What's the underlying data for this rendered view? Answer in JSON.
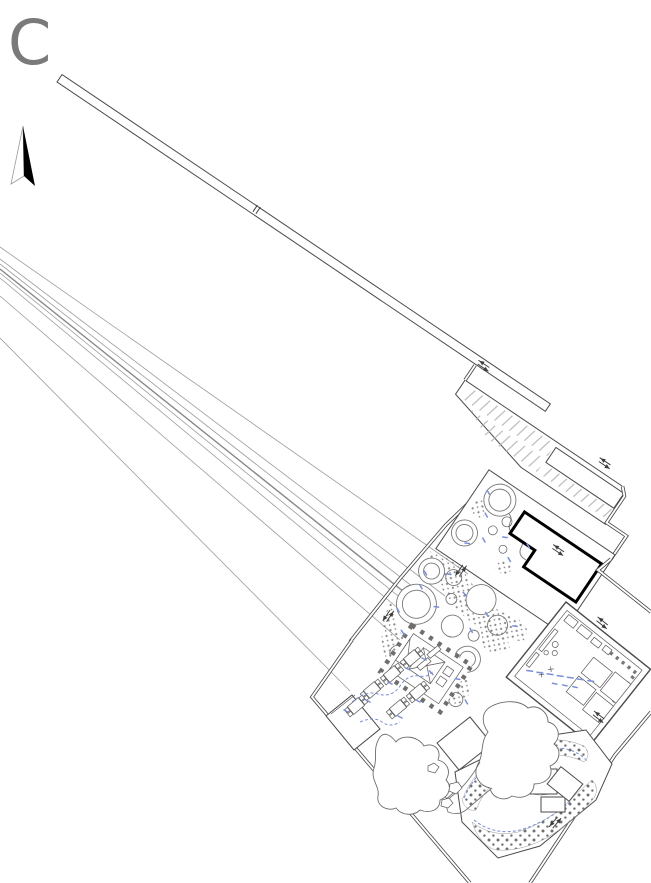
{
  "sheet": {
    "label": "C"
  },
  "colors": {
    "background": "#ffffff",
    "line": "#4a4a4a",
    "line-light": "#9c9c9c",
    "hatch": "#b5b5b5",
    "stipple": "#8c8c8c",
    "dots": "#6f6f6f",
    "accent-blue": "#7b8fd6",
    "building-outline": "#000000",
    "label-gray": "#7a7a7a"
  },
  "icons": {
    "north_arrow": "north-arrow",
    "flow_arrows": "double-arrow",
    "door_tick": "door-tick"
  }
}
